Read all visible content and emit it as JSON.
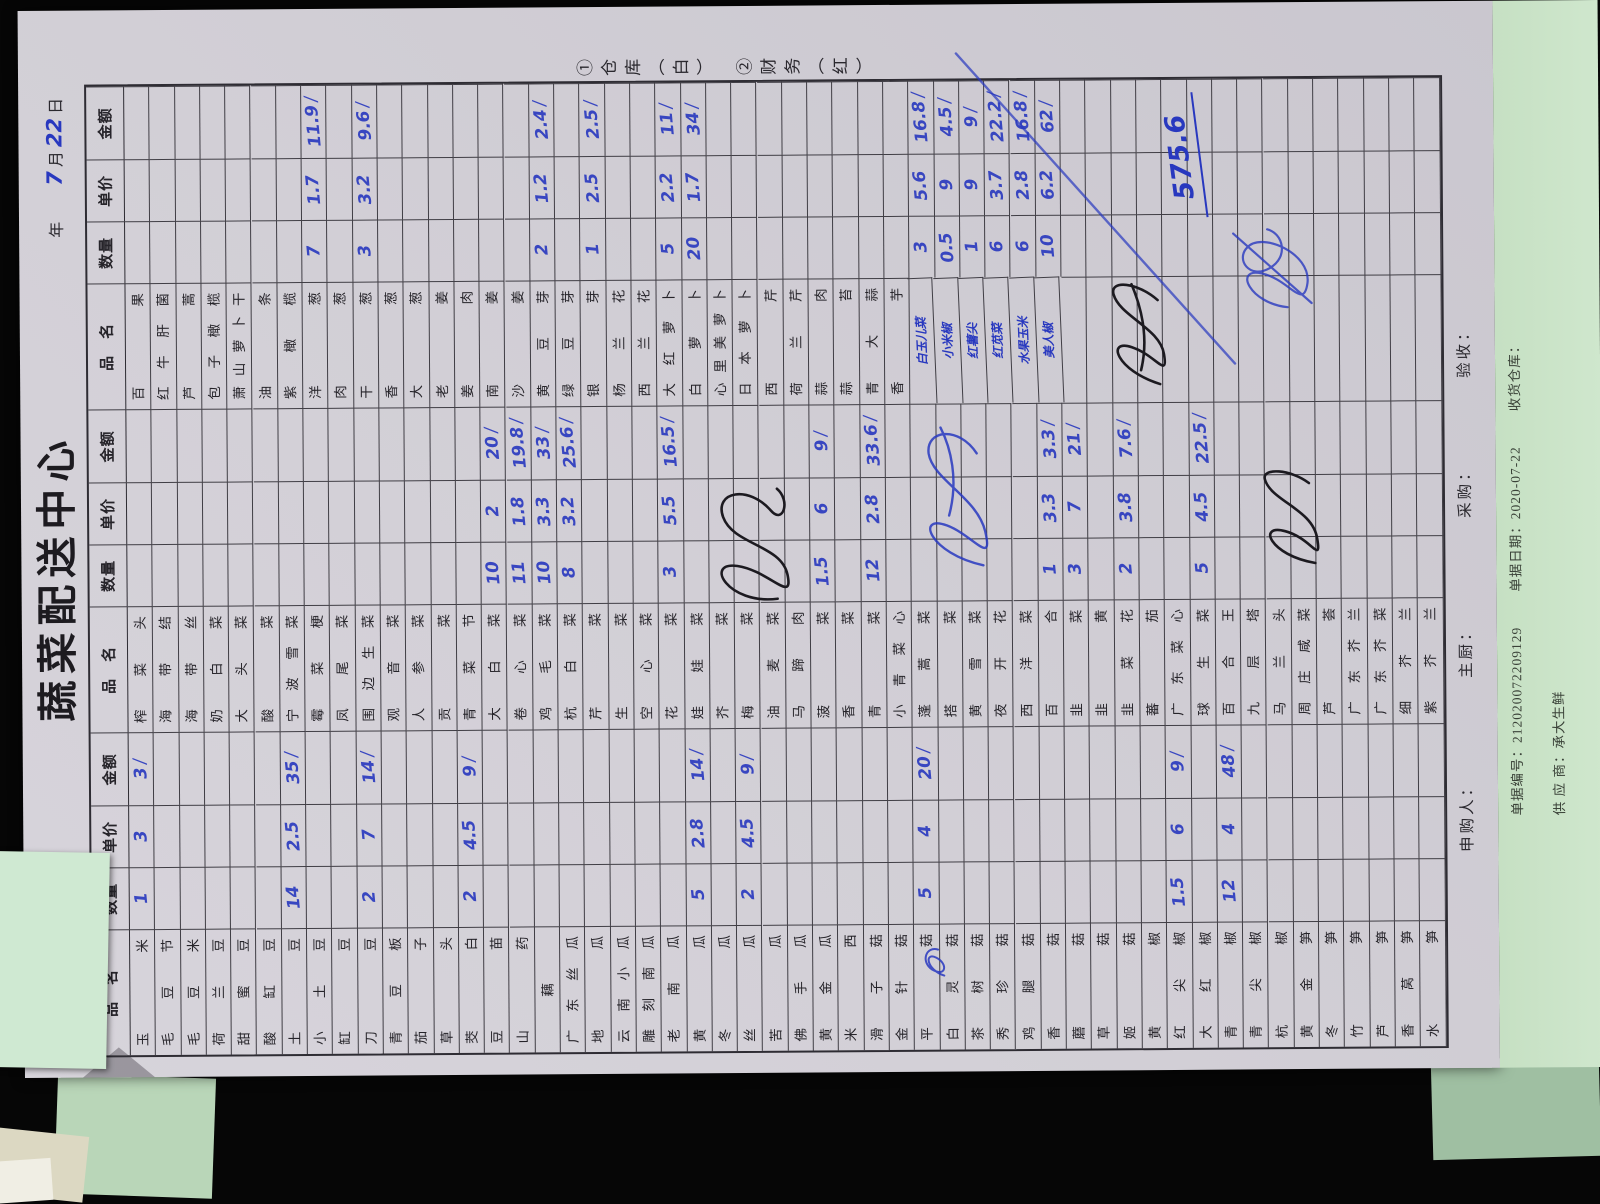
{
  "document": {
    "title": "蔬菜配送中心",
    "date": {
      "year_label": "年",
      "month_value": "7",
      "month_label": "月",
      "day_value": "22",
      "day_label": "日"
    },
    "side_note": "①仓库（白）　②财务（红）",
    "column_headers": [
      "品　名",
      "数量",
      "单价",
      "金额"
    ],
    "total": "575.6",
    "footer_labels": [
      "申购人：",
      "主厨：",
      "采购：",
      "验收："
    ],
    "under_sheet": {
      "line1": "单据编号：212020072209129        单据日期：2020-07-22        收货仓库：",
      "line2": "供 应 商：承大生鲜"
    },
    "ink": {
      "blue": "#2838bf",
      "black": "#1c1a20"
    },
    "groups": [
      {
        "rows": [
          [
            "玉米",
            "1",
            "3",
            "3"
          ],
          [
            "毛豆节"
          ],
          [
            "毛豆米"
          ],
          [
            "荷兰豆"
          ],
          [
            "甜蜜豆"
          ],
          [
            "酸缸豆"
          ],
          [
            "土豆",
            "14",
            "2.5",
            "35"
          ],
          [
            "小土豆"
          ],
          [
            "缸豆"
          ],
          [
            "刀豆",
            "2",
            "7",
            "14"
          ],
          [
            "青豆板"
          ],
          [
            "茄子"
          ],
          [
            "草头"
          ],
          [
            "茭白",
            "2",
            "4.5",
            "9"
          ],
          [
            "豆苗"
          ],
          [
            "山药"
          ],
          [
            "藕"
          ],
          [
            "广东丝瓜"
          ],
          [
            "地瓜"
          ],
          [
            "云南小瓜"
          ],
          [
            "雕刻南瓜"
          ],
          [
            "老南瓜"
          ],
          [
            "黄瓜",
            "5",
            "2.8",
            "14"
          ],
          [
            "冬瓜"
          ],
          [
            "丝瓜",
            "2",
            "4.5",
            "9"
          ],
          [
            "苦瓜"
          ],
          [
            "佛手瓜"
          ],
          [
            "黄金瓜"
          ],
          [
            "米西"
          ],
          [
            "滑子菇"
          ],
          [
            "金针菇"
          ],
          [
            "平菇",
            "5",
            "4",
            "20"
          ],
          [
            "白灵菇"
          ],
          [
            "茶树菇"
          ],
          [
            "秀珍菇"
          ],
          [
            "鸡腿菇"
          ],
          [
            "香菇"
          ],
          [
            "蘑菇"
          ],
          [
            "草菇"
          ],
          [
            "姬菇"
          ],
          [
            "黄椒"
          ],
          [
            "红尖椒",
            "1.5",
            "6",
            "9"
          ],
          [
            "大红椒"
          ],
          [
            "青椒",
            "12",
            "4",
            "48"
          ],
          [
            "青尖椒"
          ],
          [
            "杭椒"
          ],
          [
            "黄金笋"
          ],
          [
            "冬笋"
          ],
          [
            "竹笋"
          ],
          [
            "芦笋"
          ],
          [
            "香莴笋"
          ],
          [
            "水笋"
          ]
        ]
      },
      {
        "rows": [
          [
            "榨菜头"
          ],
          [
            "海带结"
          ],
          [
            "海带丝"
          ],
          [
            "奶白菜"
          ],
          [
            "大头菜"
          ],
          [
            "酸菜"
          ],
          [
            "宁波雪菜"
          ],
          [
            "霉菜梗"
          ],
          [
            "凤尾菜"
          ],
          [
            "围边生菜"
          ],
          [
            "观音菜"
          ],
          [
            "人参菜"
          ],
          [
            "贡菜"
          ],
          [
            "青菜节"
          ],
          [
            "大白菜",
            "10",
            "2",
            "20"
          ],
          [
            "卷心菜",
            "11",
            "1.8",
            "19.8"
          ],
          [
            "鸡毛菜",
            "10",
            "3.3",
            "33"
          ],
          [
            "杭白菜",
            "8",
            "3.2",
            "25.6"
          ],
          [
            "芹菜"
          ],
          [
            "生菜"
          ],
          [
            "空心菜"
          ],
          [
            "花菜",
            "3",
            "5.5",
            "16.5"
          ],
          [
            "娃娃菜"
          ],
          [
            "芥菜"
          ],
          [
            "梅菜"
          ],
          [
            "油麦菜"
          ],
          [
            "马蹄肉"
          ],
          [
            "菠菜",
            "1.5",
            "6",
            "9"
          ],
          [
            "香菜"
          ],
          [
            "青菜",
            "12",
            "2.8",
            "33.6"
          ],
          [
            "小青菜心"
          ],
          [
            "蓬蒿菜"
          ],
          [
            "搭菜"
          ],
          [
            "黄雪菜"
          ],
          [
            "夜开花"
          ],
          [
            "西洋菜"
          ],
          [
            "百合",
            "1",
            "3.3",
            "3.3"
          ],
          [
            "韭菜",
            "3",
            "7",
            "21"
          ],
          [
            "韭黄"
          ],
          [
            "韭菜花",
            "2",
            "3.8",
            "7.6"
          ],
          [
            "蕃茄"
          ],
          [
            "广东菜心"
          ],
          [
            "球生菜",
            "5",
            "4.5",
            "22.5"
          ],
          [
            "百合王"
          ],
          [
            "九层塔"
          ],
          [
            "马兰头"
          ],
          [
            "周庄咸菜"
          ],
          [
            "芦荟"
          ],
          [
            "广东芥兰"
          ],
          [
            "广东芥菜"
          ],
          [
            "细芥兰"
          ],
          [
            "紫芥兰"
          ]
        ]
      },
      {
        "rows": [
          [
            "百果"
          ],
          [
            "红牛肝菌"
          ],
          [
            "芦蒿"
          ],
          [
            "包子橄榄"
          ],
          [
            "萧山萝卜干"
          ],
          [
            "油条"
          ],
          [
            "紫橄榄"
          ],
          [
            "洋葱",
            "7",
            "1.7",
            "11.9"
          ],
          [
            "肉葱"
          ],
          [
            "干葱",
            "3",
            "3.2",
            "9.6"
          ],
          [
            "香葱"
          ],
          [
            "大葱"
          ],
          [
            "老姜"
          ],
          [
            "姜肉"
          ],
          [
            "南姜"
          ],
          [
            "沙姜"
          ],
          [
            "黄豆芽",
            "2",
            "1.2",
            "2.4"
          ],
          [
            "绿豆芽"
          ],
          [
            "银芽",
            "1",
            "2.5",
            "2.5"
          ],
          [
            "杨兰花"
          ],
          [
            "西兰花"
          ],
          [
            "大红萝卜",
            "5",
            "2.2",
            "11"
          ],
          [
            "白萝卜",
            "20",
            "1.7",
            "34"
          ],
          [
            "心里美萝卜"
          ],
          [
            "日本萝卜"
          ],
          [
            "西芹"
          ],
          [
            "荷兰芹"
          ],
          [
            "蒜肉"
          ],
          [
            "蒜苔"
          ],
          [
            "青大蒜"
          ],
          [
            "香芋"
          ],
          [
            "白玉儿菜",
            "3",
            "5.6",
            "16.8",
            "h"
          ],
          [
            "小米椒",
            "0.5",
            "9",
            "4.5",
            "h"
          ],
          [
            "红薯尖",
            "1",
            "9",
            "9",
            "h"
          ],
          [
            "红苋菜",
            "6",
            "3.7",
            "22.2",
            "h"
          ],
          [
            "水果玉米",
            "6",
            "2.8",
            "16.8",
            "h"
          ],
          [
            "美人椒",
            "10",
            "6.2",
            "62",
            "h"
          ],
          [
            ""
          ],
          [
            ""
          ],
          [
            ""
          ],
          [
            ""
          ],
          [
            ""
          ],
          [
            ""
          ],
          [
            ""
          ],
          [
            ""
          ],
          [
            ""
          ],
          [
            ""
          ],
          [
            ""
          ],
          [
            ""
          ],
          [
            ""
          ],
          [
            ""
          ],
          [
            ""
          ]
        ]
      }
    ]
  }
}
